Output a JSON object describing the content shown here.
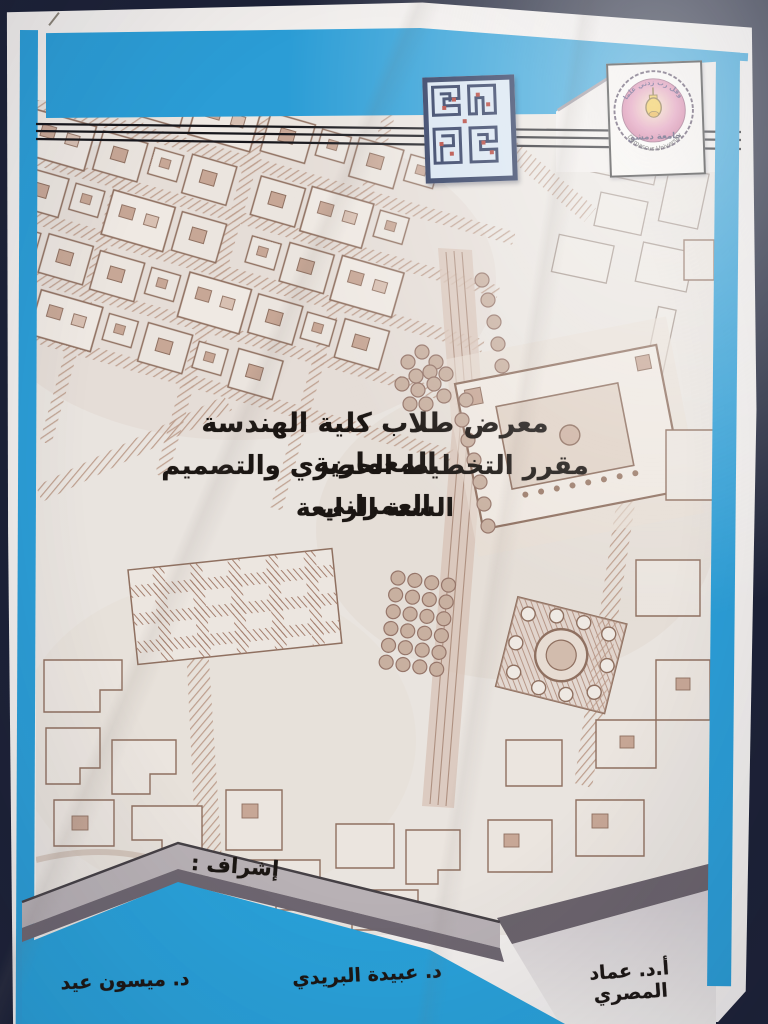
{
  "poster": {
    "title_line1": "معرض طلاب كلية الهندسة المعمارية",
    "title_line2": "مقرر التخطيط الحضري والتصميم العمراني",
    "title_line3": "السنة الرابعة",
    "supervision_label": "إشراف :",
    "supervisors": [
      "أ.د. عماد المصري",
      "د. عبيدة البريدي",
      "د. ميسون عيد"
    ]
  },
  "logo": {
    "motto": "وقل رب زدني علما",
    "name_ar": "جامعة دمشق",
    "name_en": "Damascus University"
  },
  "colors": {
    "accent_blue": "#2b9dd6",
    "photo_background_navy": "#1c2136",
    "map_ink_sepia": "#8f7060",
    "band_grey_light": "#b8b1b5",
    "band_grey_dark": "#6b636c",
    "kufic_navy": "#223057",
    "logo_pink": "#d97ba4",
    "logo_yellow": "#f2c12e"
  }
}
